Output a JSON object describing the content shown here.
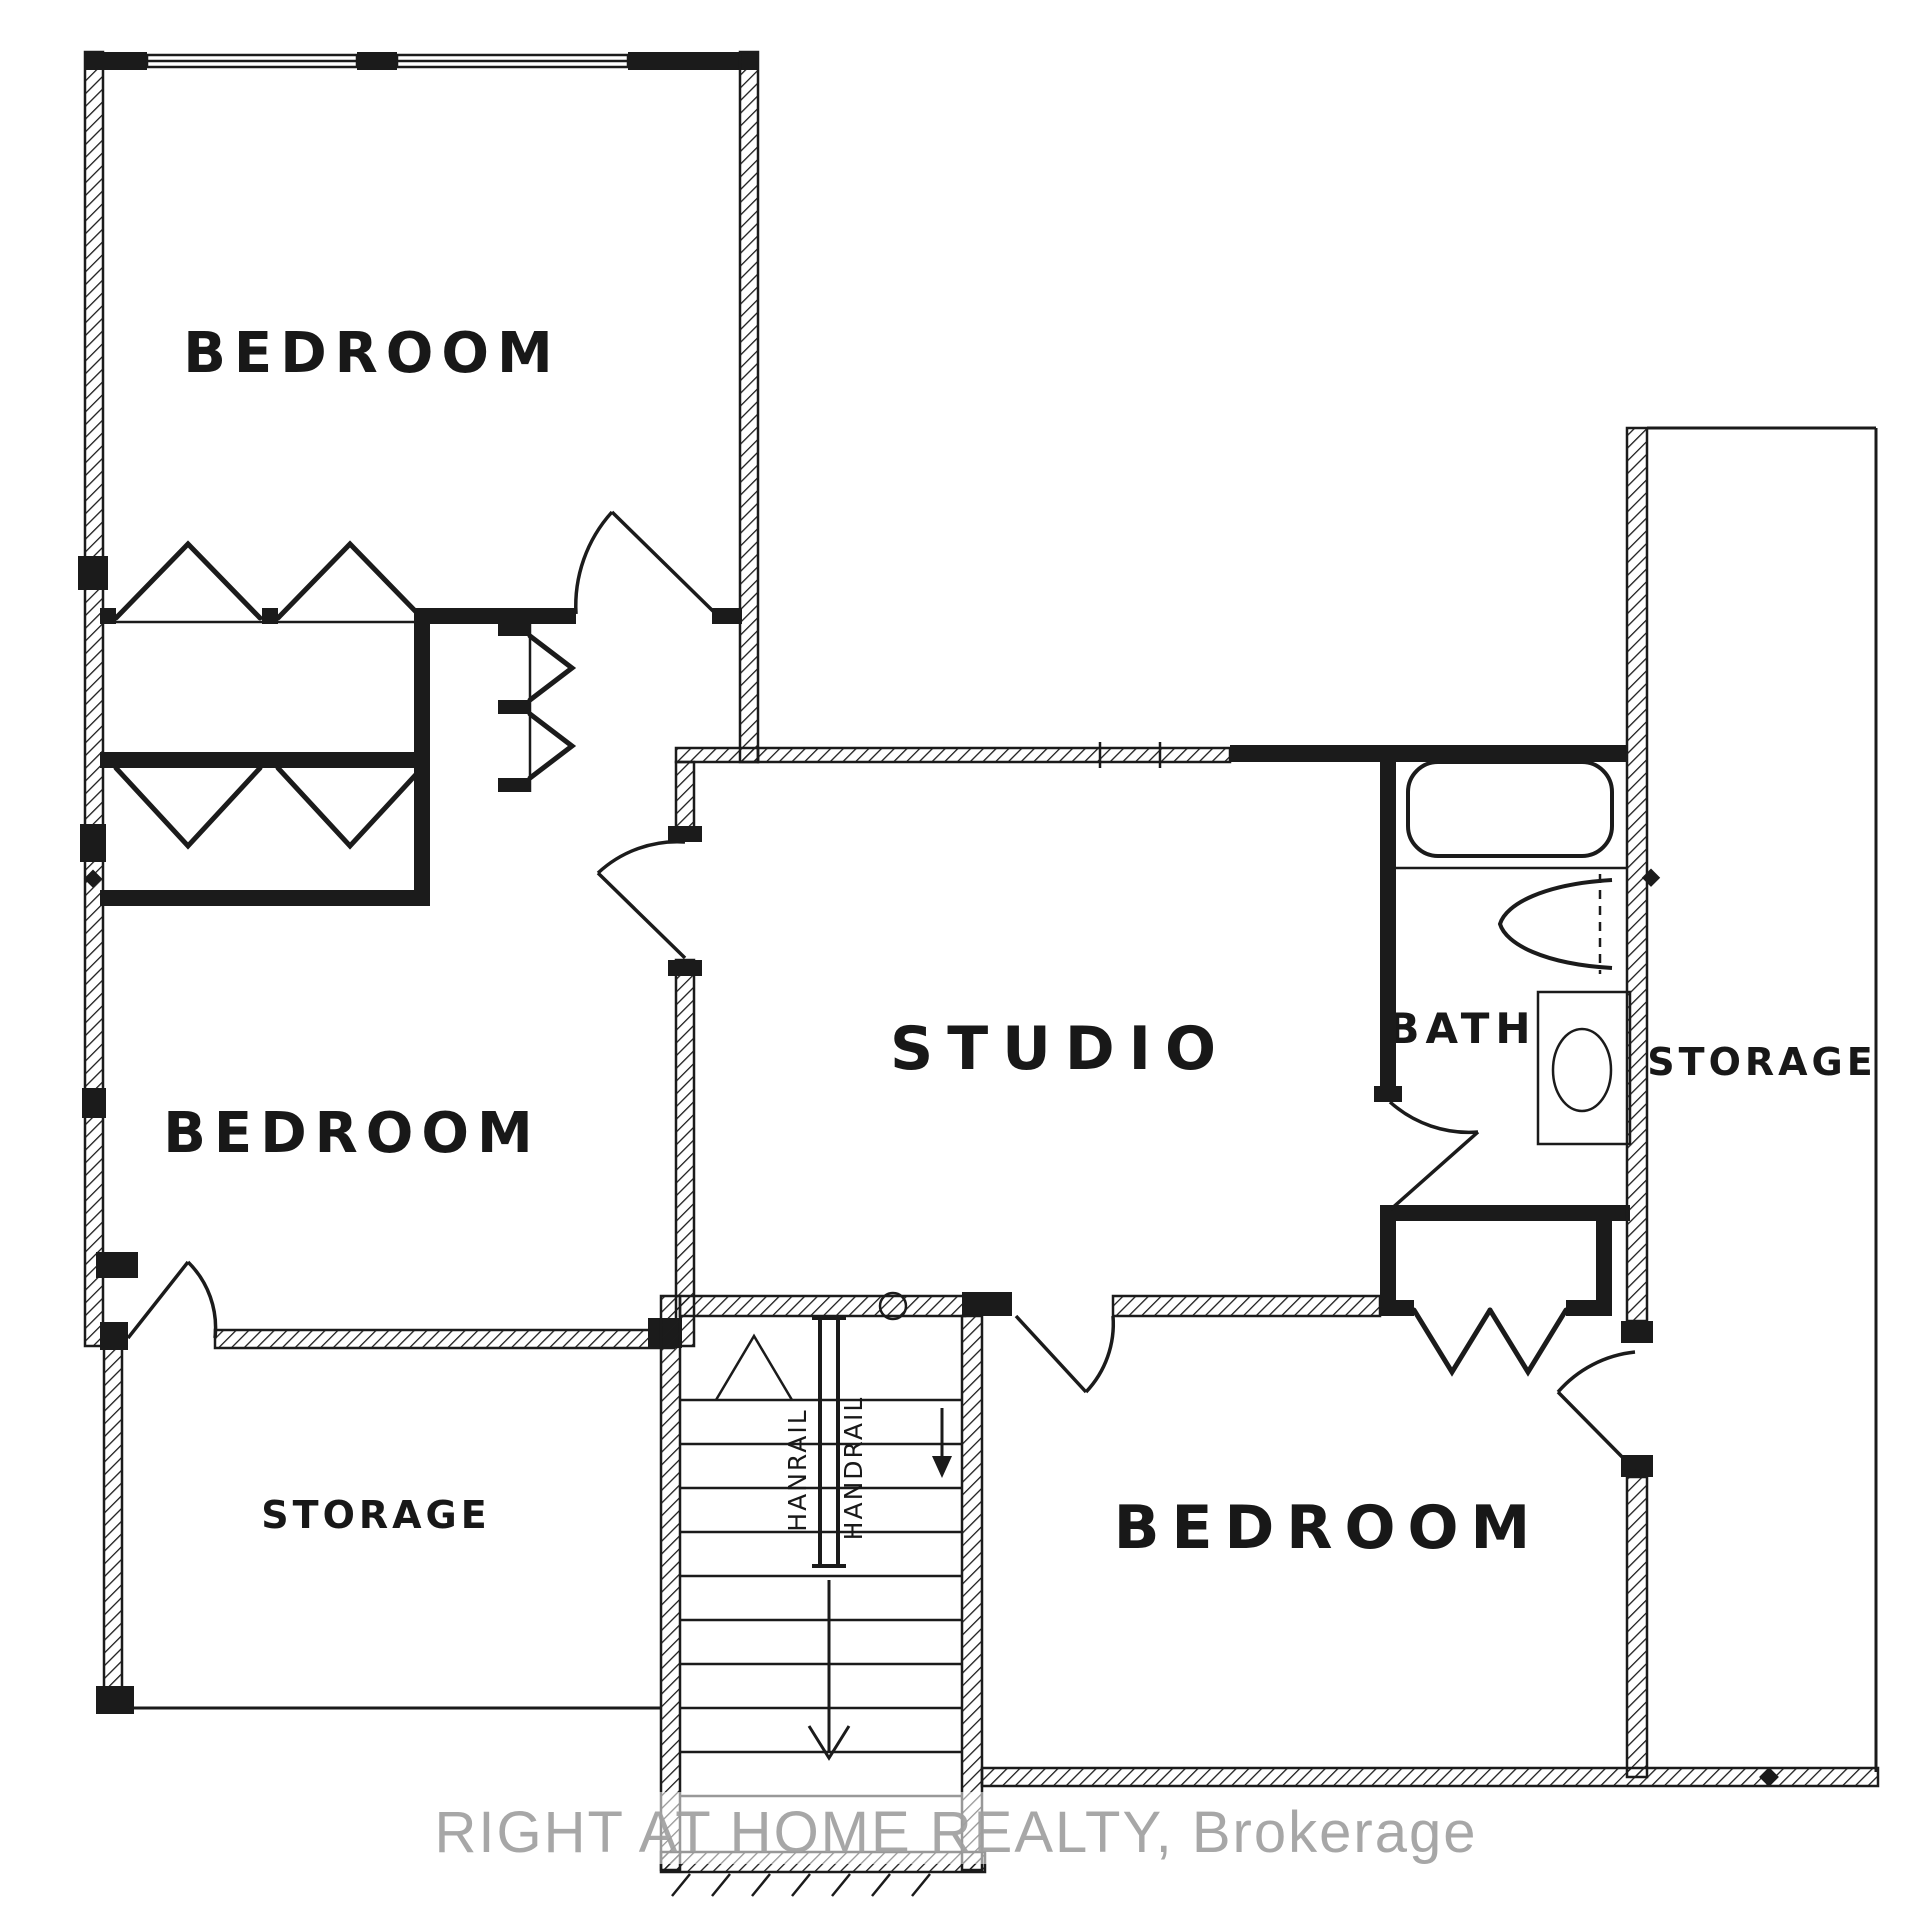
{
  "plan": {
    "title": "Upper level floor plan (hand-drawn architectural sketch)",
    "rooms": [
      {
        "id": "bedroom-1",
        "label": "BEDROOM"
      },
      {
        "id": "bedroom-2",
        "label": "BEDROOM"
      },
      {
        "id": "studio",
        "label": "STUDIO"
      },
      {
        "id": "bath",
        "label": "BATH"
      },
      {
        "id": "storage-east",
        "label": "STORAGE"
      },
      {
        "id": "storage-west",
        "label": "STORAGE"
      },
      {
        "id": "bedroom-3",
        "label": "BEDROOM"
      }
    ],
    "stairs": {
      "handrail_left_label": "HANRAIL",
      "handrail_right_label": "HANDRAIL"
    },
    "fixtures": [
      "bathtub-icon",
      "sink-icon",
      "toilet-icon",
      "stairs-icon",
      "door-swing-icon",
      "bifold-closet-door-icon",
      "up-arrow-icon",
      "down-arrow-icon"
    ],
    "watermark": "RIGHT AT HOME REALTY, Brokerage",
    "colors": {
      "ink": "#1b1b1b",
      "background": "#ffffff",
      "watermark": "#a0a0a0"
    }
  }
}
